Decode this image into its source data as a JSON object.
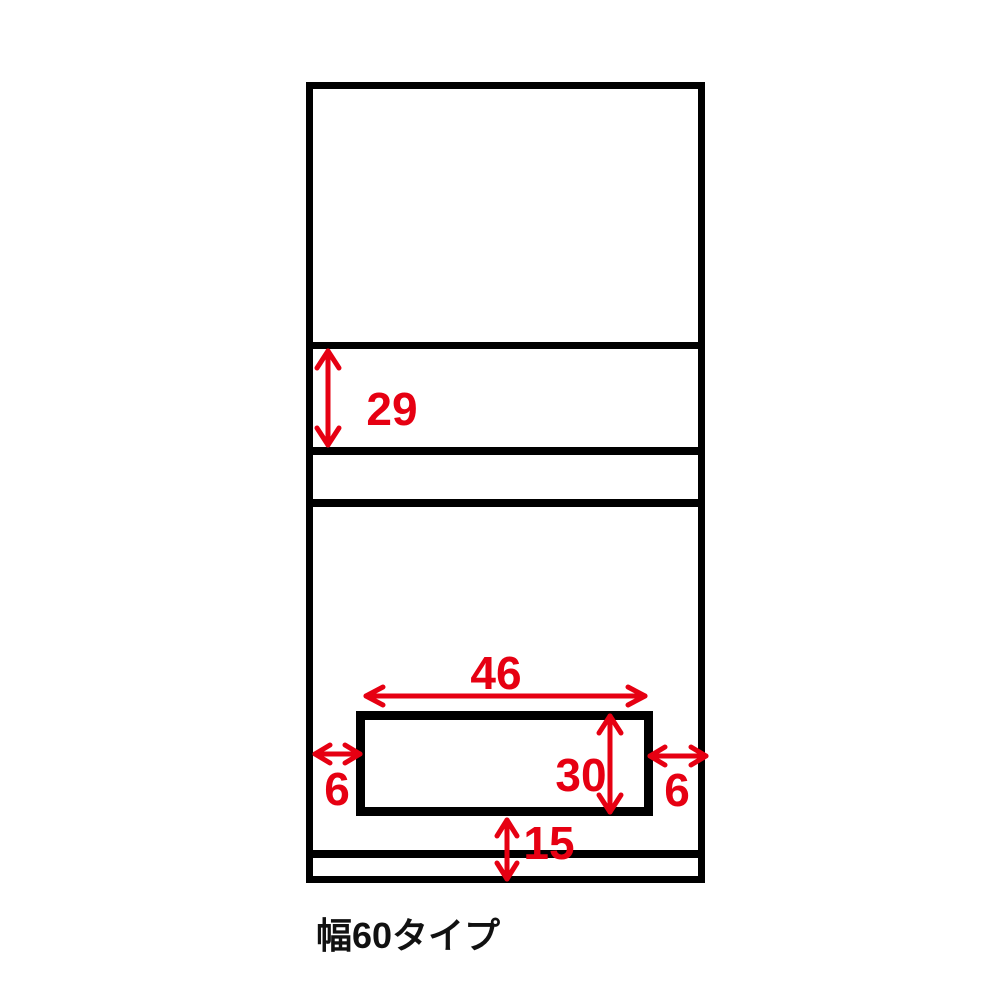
{
  "caption": "幅60タイプ",
  "colors": {
    "dimension_red": "#e60012",
    "outline_black": "#000000"
  },
  "dimensions": {
    "flap_section_height": "29",
    "opening_width": "46",
    "opening_height": "30",
    "left_clearance": "6",
    "right_clearance": "6",
    "base_height": "15"
  }
}
